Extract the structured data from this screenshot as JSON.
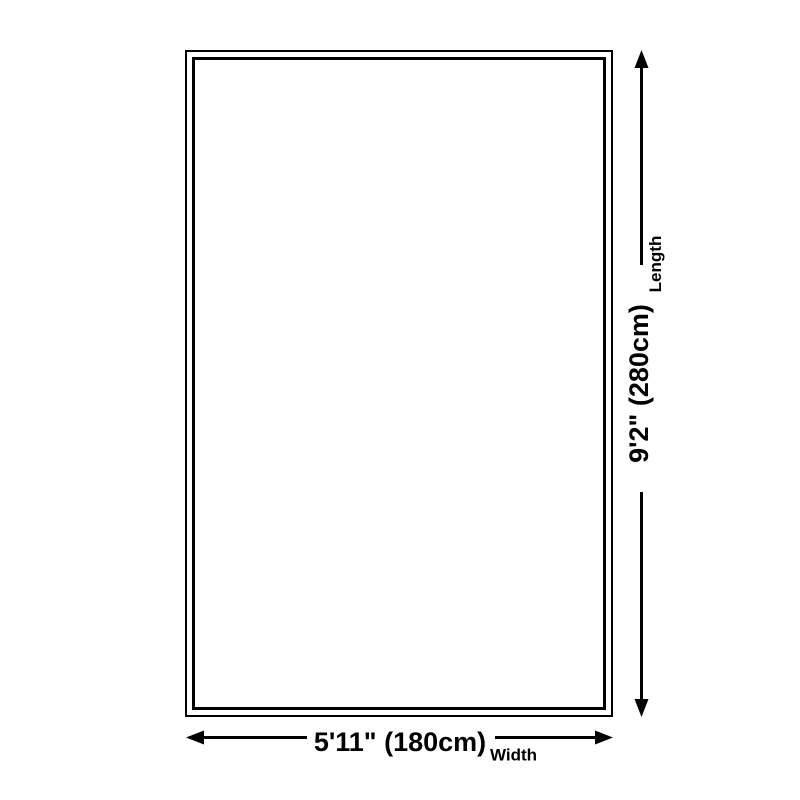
{
  "colors": {
    "ink": "#000000",
    "background": "#ffffff",
    "rug_fill": "#ffffff"
  },
  "dimensions": {
    "length": {
      "value": "9'2\" (280cm)",
      "label": "Length"
    },
    "width": {
      "value": "5'11\" (180cm)",
      "label": "Width"
    }
  }
}
